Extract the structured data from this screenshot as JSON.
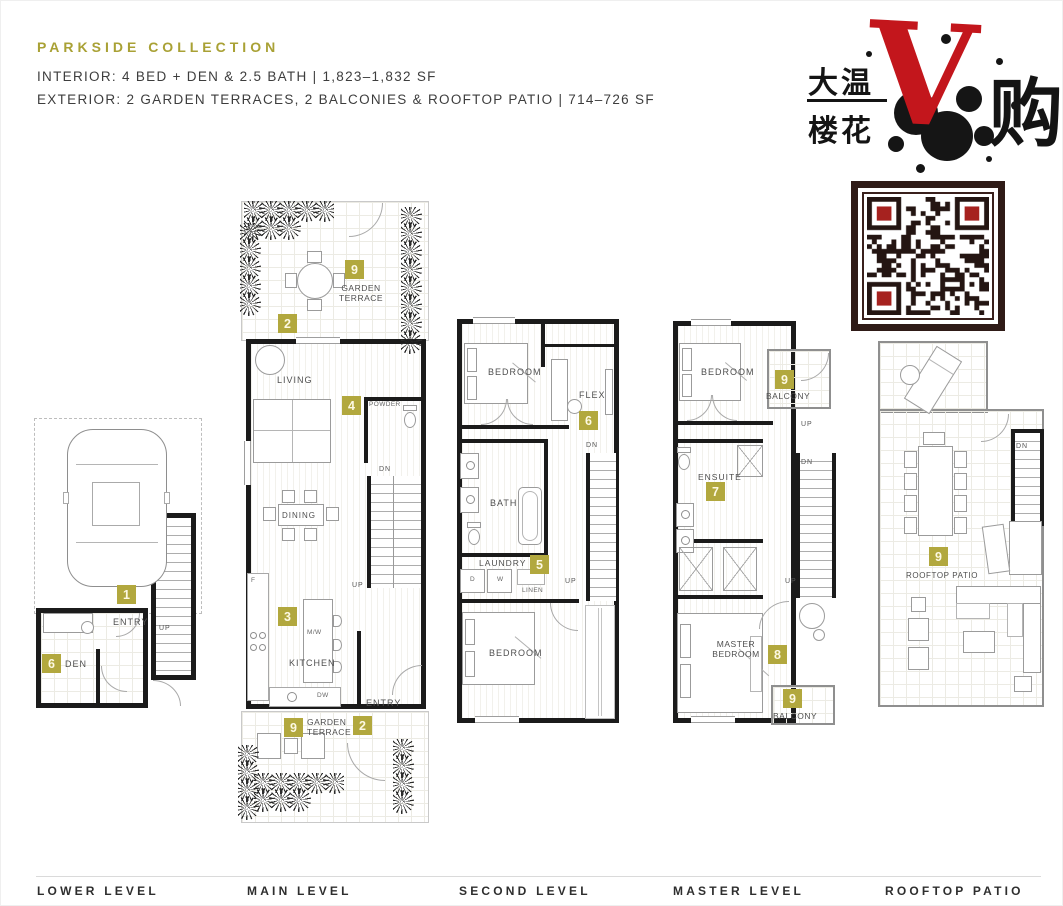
{
  "header": {
    "title": "PARKSIDE COLLECTION",
    "interior": "INTERIOR: 4 BED + DEN & 2.5 BATH | 1,823–1,832 SF",
    "exterior": "EXTERIOR: 2 GARDEN TERRACES, 2 BALCONIES & ROOFTOP PATIO | 714–726 SF",
    "accent_color": "#a9a135"
  },
  "logo": {
    "cn_top": "大温",
    "cn_bottom": "楼花",
    "v": "V",
    "cn_right": "购",
    "v_color": "#c3161c"
  },
  "qr": {
    "name": "wechat-qr-code",
    "frame_color": "#2f1b17",
    "finder_accent": "#a6221f"
  },
  "marker_color": "#b2a83e",
  "plans": {
    "lower": {
      "label": "LOWER LEVEL",
      "entry": "ENTRY",
      "den": "DEN",
      "up": "UP",
      "marker_entry": "1",
      "marker_den": "6"
    },
    "main": {
      "label": "MAIN LEVEL",
      "terrace_top": "GARDEN TERRACE",
      "marker_terrace_top": "9",
      "marker_terrace_top_door": "2",
      "living": "LIVING",
      "powder": "POWDER",
      "marker_powder": "4",
      "dining": "DINING",
      "dn": "DN",
      "up": "UP",
      "kitchen": "KITCHEN",
      "marker_kitchen": "3",
      "mw": "M/W",
      "dw": "DW",
      "fridge": "F",
      "entry": "ENTRY",
      "terrace_bottom": "GARDEN TERRACE",
      "marker_terrace_bottom": "9",
      "marker_terrace_bottom_door": "2"
    },
    "second": {
      "label": "SECOND LEVEL",
      "bedroom_top": "BEDROOM",
      "flex": "FLEX",
      "marker_flex": "6",
      "dn": "DN",
      "bath": "BATH",
      "laundry": "LAUNDRY",
      "marker_laundry": "5",
      "dryer": "D",
      "washer": "W",
      "linen": "LINEN",
      "up": "UP",
      "bedroom_bottom": "BEDROOM"
    },
    "master": {
      "label": "MASTER LEVEL",
      "bedroom": "BEDROOM",
      "balcony_top": "BALCONY",
      "marker_balcony_top": "9",
      "up_balcony": "UP",
      "ensuite": "ENSUITE",
      "marker_ensuite": "7",
      "dn": "DN",
      "master_bedroom": "MASTER BEDROOM",
      "marker_master_bedroom": "8",
      "up": "UP",
      "balcony_bottom": "BALCONY",
      "marker_balcony_bottom": "9"
    },
    "rooftop": {
      "label": "ROOFTOP PATIO",
      "dn": "DN",
      "patio": "ROOFTOP PATIO",
      "marker_patio": "9"
    }
  }
}
